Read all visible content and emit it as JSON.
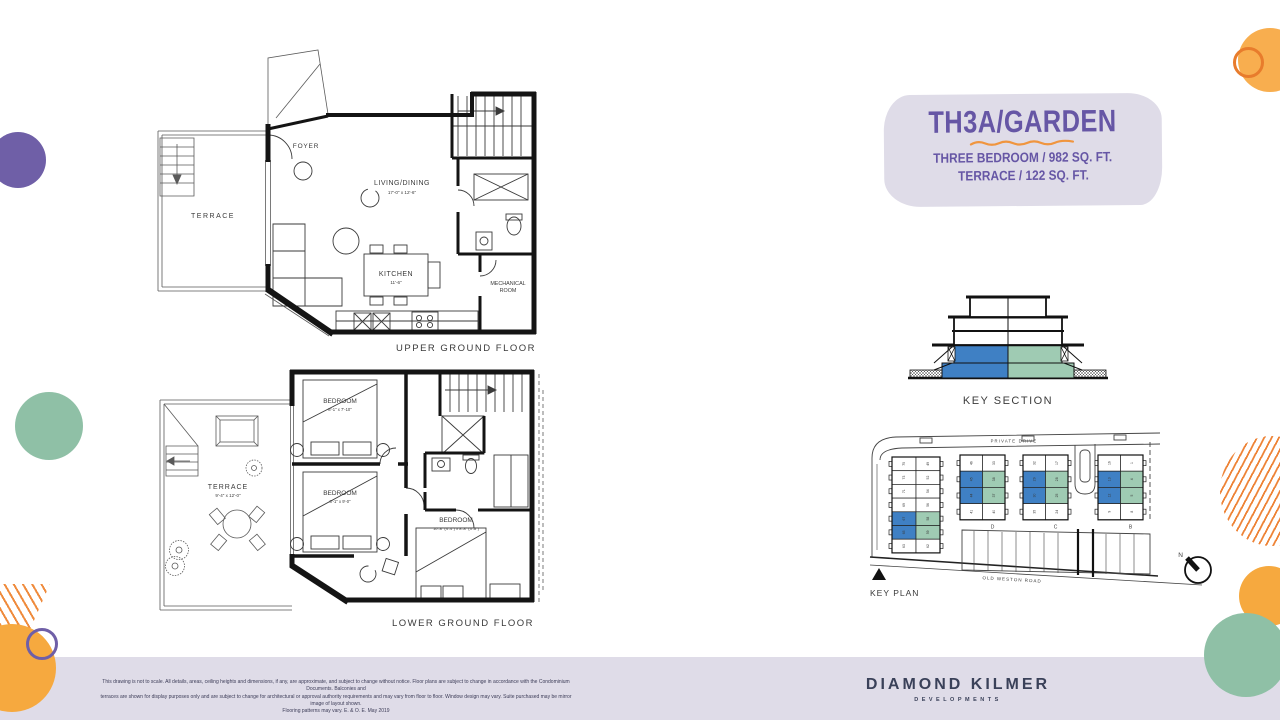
{
  "title_block": {
    "title": "TH3A/GARDEN",
    "subtitle_line1": "THREE BEDROOM / 982 SQ. FT.",
    "subtitle_line2": "TERRACE / 122 SQ. FT."
  },
  "floorplans": {
    "upper": {
      "caption": "UPPER GROUND FLOOR",
      "terrace": "TERRACE",
      "foyer": "FOYER",
      "living": "LIVING/DINING",
      "living_dims": "17'-0\" x 12'-6\"",
      "kitchen": "KITCHEN",
      "kitchen_dims": "11'-6\"",
      "mech1": "MECHANICAL",
      "mech2": "ROOM"
    },
    "lower": {
      "caption": "LOWER GROUND FLOOR",
      "terrace": "TERRACE",
      "terrace_dims": "9'-4\" x 12'-0\"",
      "bed1": "BEDROOM",
      "bed1_dims": "8'-1\" x 7'-10\"",
      "bed2": "BEDROOM",
      "bed2_dims": "8'-1\" x 9'-0\"",
      "bed3": "BEDROOM",
      "bed3_dims": "10'-8\" (4'-4\") x 8'-8\" (3'-8\")"
    }
  },
  "key_section": {
    "caption": "KEY SECTION"
  },
  "key_plan": {
    "caption": "KEY PLAN",
    "street_top": "PRIVATE DRIVE",
    "street_bottom": "OLD WESTON ROAD",
    "north_label": "N",
    "blocks": [
      {
        "letter": "",
        "rows": [
          [
            "75",
            "49"
          ],
          [
            "73",
            "52"
          ],
          [
            "71",
            "54"
          ],
          [
            "69",
            "56"
          ],
          [
            "67",
            "58"
          ],
          [
            "65",
            "59"
          ],
          [
            "63",
            "62"
          ]
        ],
        "highlight_rows": [
          4,
          5
        ]
      },
      {
        "letter": "D",
        "rows": [
          [
            "46",
            "33"
          ],
          [
            "45",
            "38"
          ],
          [
            "44",
            "37"
          ],
          [
            "41",
            "40"
          ]
        ],
        "highlight_rows": [
          1,
          2
        ]
      },
      {
        "letter": "C",
        "rows": [
          [
            "32",
            "17"
          ],
          [
            "29",
            "28"
          ],
          [
            "30",
            "25"
          ],
          [
            "35",
            "24"
          ]
        ],
        "highlight_rows": [
          1,
          2
        ]
      },
      {
        "letter": "B",
        "rows": [
          [
            "16",
            "1"
          ],
          [
            "13",
            "4"
          ],
          [
            "12",
            "5"
          ],
          [
            "9",
            "8"
          ]
        ],
        "highlight_rows": [
          1,
          2
        ]
      }
    ]
  },
  "footer": {
    "line1": "This drawing is not to scale. All details, areas, ceiling heights and dimensions, if any, are approximate, and subject to change without notice. Floor plans are subject to change in accordance with the Condominium Documents. Balconies and",
    "line2": "terraces are shown for display purposes only and are subject to change for architectural or approval authority requirements and may vary from floor to floor. Window design may vary. Suite purchased may be mirror image of layout shown.",
    "line3": "Flooring patterns may vary. E. & O. E. May 2019"
  },
  "brand": {
    "name": "DIAMOND KILMER",
    "sub": "DEVELOPMENTS"
  },
  "colors": {
    "accent_purple": "#6656A5",
    "accent_orange": "#F0953F",
    "unit_blue": "#3F80C4",
    "unit_green": "#9FCBB3",
    "band_lavender": "#DFDCE8",
    "brand_navy": "#3A4159",
    "deco_purple": "#6F5FA7",
    "deco_teal": "#8FC0A6",
    "deco_orange": "#F6A93F",
    "ring_orange": "#E87C2C"
  }
}
